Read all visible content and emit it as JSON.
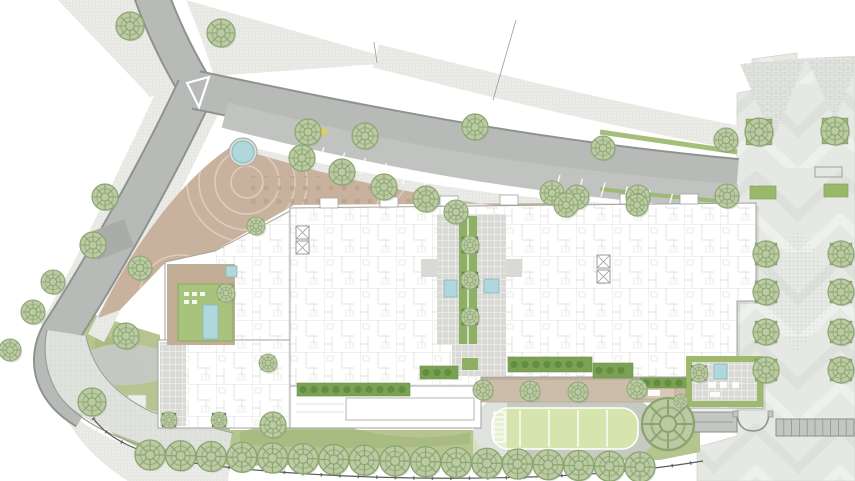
{
  "plan": {
    "title": "Residential block site plan drawing",
    "canvas": {
      "width": 855,
      "height": 481
    }
  },
  "palette": {
    "paper": "#ffffff",
    "road": "#b7bab6",
    "road_light": "#c0c3bf",
    "road_dark": "#a9aca8",
    "curb": "#8f938f",
    "sidewalk": "#e7e8e4",
    "tan": "#c9b29d",
    "tan_light": "#d8c9b6",
    "tan_line": "#dccdbb",
    "building": "#ffffff",
    "building_edge": "#a2a2a0",
    "room_line": "#d6d6d4",
    "court_grey": "#d9d9d5",
    "lawn": "#b6c590",
    "lawn_dark": "#a5b87c",
    "field": "#d6e4ae",
    "hedge": "#7ba155",
    "hedge_dark": "#5f8a3e",
    "green_roof": "#a8c37b",
    "green_spine": "#8db065",
    "planter": "#6f9447",
    "bed": "#9ab86a",
    "pool": "#aed8dc",
    "tree_fill": "#bccaa4",
    "tree_line": "#8aa570",
    "tree_pale_fill": "#d4dbc7",
    "tree_pale_line": "#aab79b",
    "shadow": "#9aa09a",
    "plaza": "#e6e8e4",
    "plaza_band": "#dde0db",
    "white_mark": "#ffffff",
    "yellow_mark": "#e3cf4e",
    "fence": "#5a5d5a",
    "structure": "#c3c6c2"
  },
  "features": {
    "trees_round": [
      {
        "x": 130,
        "y": 26,
        "r": 14
      },
      {
        "x": 221,
        "y": 33,
        "r": 14
      },
      {
        "x": 105,
        "y": 197,
        "r": 13
      },
      {
        "x": 93,
        "y": 245,
        "r": 13
      },
      {
        "x": 53,
        "y": 282,
        "r": 12
      },
      {
        "x": 33,
        "y": 312,
        "r": 12
      },
      {
        "x": 10,
        "y": 350,
        "r": 11
      },
      {
        "x": 140,
        "y": 268,
        "r": 12
      },
      {
        "x": 126,
        "y": 336,
        "r": 13
      },
      {
        "x": 92,
        "y": 402,
        "r": 14
      },
      {
        "x": 308,
        "y": 132,
        "r": 13
      },
      {
        "x": 365,
        "y": 136,
        "r": 13
      },
      {
        "x": 302,
        "y": 158,
        "r": 13
      },
      {
        "x": 342,
        "y": 172,
        "r": 13
      },
      {
        "x": 384,
        "y": 187,
        "r": 13
      },
      {
        "x": 426,
        "y": 199,
        "r": 13
      },
      {
        "x": 475,
        "y": 127,
        "r": 13
      },
      {
        "x": 552,
        "y": 193,
        "r": 12
      },
      {
        "x": 603,
        "y": 148,
        "r": 12
      },
      {
        "x": 726,
        "y": 140,
        "r": 12
      },
      {
        "x": 577,
        "y": 197,
        "r": 12
      },
      {
        "x": 638,
        "y": 197,
        "r": 12
      },
      {
        "x": 727,
        "y": 196,
        "r": 12
      },
      {
        "x": 456,
        "y": 212,
        "r": 12
      },
      {
        "x": 566,
        "y": 205,
        "r": 12
      },
      {
        "x": 637,
        "y": 205,
        "r": 11
      },
      {
        "x": 668,
        "y": 424,
        "r": 26,
        "v": "pale"
      },
      {
        "x": 273,
        "y": 425,
        "r": 13,
        "v": "pale"
      },
      {
        "x": 681,
        "y": 401,
        "r": 7
      }
    ],
    "trees_bottom_row": {
      "x_start": 150,
      "x_end": 640,
      "count": 17,
      "y_start": 455,
      "y_end": 467,
      "r": 15
    },
    "planter_trees": [
      {
        "x": 470,
        "y": 245,
        "s": 16,
        "r": 9
      },
      {
        "x": 470,
        "y": 280,
        "s": 16,
        "r": 9
      },
      {
        "x": 470,
        "y": 317,
        "s": 16,
        "r": 9
      },
      {
        "x": 483,
        "y": 390,
        "s": 15,
        "r": 10,
        "pf": "#c9bcab"
      },
      {
        "x": 530,
        "y": 391,
        "s": 15,
        "r": 10,
        "pf": "#c9bcab"
      },
      {
        "x": 578,
        "y": 392,
        "s": 15,
        "r": 10,
        "pf": "#c9bcab"
      },
      {
        "x": 637,
        "y": 389,
        "s": 15,
        "r": 10,
        "pf": "#c9bcab"
      },
      {
        "x": 759,
        "y": 132,
        "s": 26,
        "r": 14,
        "pf": "#9ab86a"
      },
      {
        "x": 835,
        "y": 131,
        "s": 26,
        "r": 14,
        "pf": "#9ab86a"
      },
      {
        "x": 766,
        "y": 254,
        "s": 22,
        "r": 13,
        "pf": "#9ab86a"
      },
      {
        "x": 766,
        "y": 292,
        "s": 22,
        "r": 13,
        "pf": "#9ab86a"
      },
      {
        "x": 766,
        "y": 332,
        "s": 22,
        "r": 13,
        "pf": "#9ab86a"
      },
      {
        "x": 766,
        "y": 370,
        "s": 22,
        "r": 13,
        "pf": "#9ab86a"
      },
      {
        "x": 841,
        "y": 254,
        "s": 22,
        "r": 13,
        "pf": "#9ab86a"
      },
      {
        "x": 841,
        "y": 292,
        "s": 22,
        "r": 13,
        "pf": "#9ab86a"
      },
      {
        "x": 841,
        "y": 332,
        "s": 22,
        "r": 13,
        "pf": "#9ab86a"
      },
      {
        "x": 841,
        "y": 370,
        "s": 22,
        "r": 13,
        "pf": "#9ab86a"
      },
      {
        "x": 226,
        "y": 293,
        "s": 14,
        "r": 9
      },
      {
        "x": 699,
        "y": 373,
        "s": 15,
        "r": 9
      },
      {
        "x": 256,
        "y": 226,
        "s": 14,
        "r": 9
      },
      {
        "x": 169,
        "y": 420,
        "s": 14,
        "r": 8
      },
      {
        "x": 219,
        "y": 420,
        "s": 14,
        "r": 8
      },
      {
        "x": 268,
        "y": 363,
        "s": 14,
        "r": 9
      }
    ],
    "hedges": [
      {
        "x": 297,
        "y": 383,
        "w": 113,
        "h": 13
      },
      {
        "x": 420,
        "y": 366,
        "w": 38,
        "h": 13
      },
      {
        "x": 508,
        "y": 357,
        "w": 84,
        "h": 15
      },
      {
        "x": 593,
        "y": 363,
        "w": 40,
        "h": 15
      },
      {
        "x": 640,
        "y": 378,
        "w": 46,
        "h": 10
      }
    ],
    "pools": [
      {
        "x": 444,
        "y": 280,
        "w": 13,
        "h": 17
      },
      {
        "x": 484,
        "y": 279,
        "w": 15,
        "h": 14
      },
      {
        "x": 203,
        "y": 305,
        "w": 15,
        "h": 34
      },
      {
        "x": 226,
        "y": 266,
        "w": 11,
        "h": 11
      },
      {
        "x": 714,
        "y": 364,
        "w": 13,
        "h": 15
      }
    ],
    "beds": [
      {
        "x": 750,
        "y": 186,
        "w": 26,
        "h": 13
      },
      {
        "x": 824,
        "y": 184,
        "w": 24,
        "h": 13
      }
    ],
    "bench": {
      "x": 815,
      "y": 167,
      "w": 27,
      "h": 10
    },
    "fountain": {
      "cx": 243,
      "cy": 152,
      "r": 11
    },
    "field": {
      "x": 492,
      "y": 408,
      "w": 146,
      "h": 41,
      "rx": 16,
      "line_xs": [
        520,
        549,
        578,
        607
      ],
      "ring": {
        "x": 474,
        "y": 399,
        "w": 182,
        "h": 58,
        "rx": 26
      },
      "canopy": {
        "x": 473,
        "y": 400,
        "w": 34,
        "h": 56
      }
    },
    "ladder": {
      "x": 494,
      "y": 412,
      "w": 11,
      "h": 30,
      "rungs": 6
    },
    "parking": [
      {
        "x": 303,
        "y": 142,
        "dx": 20.8,
        "dy": 5.3,
        "lx": -4.5,
        "ly": 16,
        "count": 7
      },
      {
        "x": 560,
        "y": 175,
        "dx": 22.5,
        "dy": 3.8,
        "lx": -4,
        "ly": 14,
        "count": 6
      }
    ],
    "storage": {
      "x": 776,
      "y": 419,
      "w": 78,
      "h": 17,
      "count": 10
    }
  }
}
